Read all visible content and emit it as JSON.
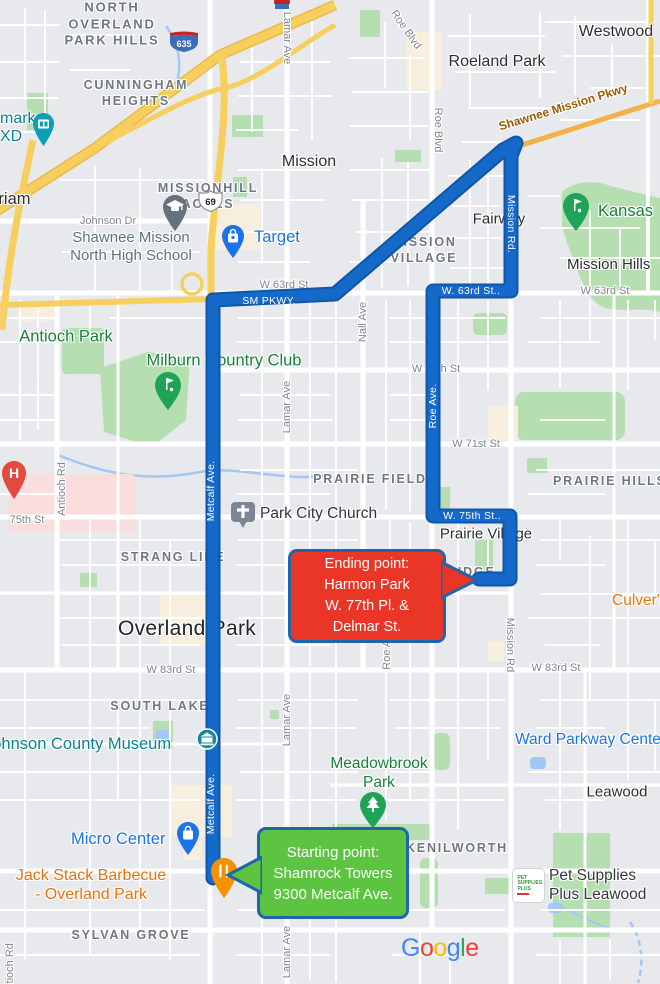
{
  "colors": {
    "route": "#1569c9",
    "route_casing": "#0e57a8",
    "park_green": "#b5dfb0",
    "water_blue": "#a2c6f5",
    "highway_yellow": "#f6cf5e",
    "poi_blue": "#1a73e8",
    "poi_green": "#188038",
    "poi_teal": "#0c818f",
    "poi_orange": "#e8710a",
    "hospital_red": "#e04a3f",
    "restaurant_pin_orange": "#f39200",
    "callout_border_blue": "#1f64ad",
    "callout_red": "#ea3626",
    "callout_green": "#5cc441"
  },
  "route": {
    "labels": {
      "sm_pkwy": "SM PKWY.",
      "w63rd": "W. 63rd St..",
      "mission_rd": "Mission Rd.",
      "roe_ave": "Roe Ave.",
      "metcalf_ave": "Metcalf Ave.",
      "w75th": "W. 75th St.."
    }
  },
  "callouts": {
    "end": {
      "text": "Ending point:\nHarmon Park\nW. 77th Pl. &\nDelmar St.",
      "fill": "#ea3626",
      "border": "#1f64ad"
    },
    "start": {
      "text": "Starting point:\nShamrock Towers\n9300 Metcalf Ave.",
      "fill": "#5cc441",
      "border": "#1f64ad"
    }
  },
  "cities": {
    "merriam": "Merriam",
    "mission": "Mission",
    "roeland_park": "Roeland Park",
    "westwood": "Westwood",
    "fairway": "Fairway",
    "mission_hills": "Mission Hills",
    "prairie_village": "Prairie Village",
    "overland_park": "Overland Park",
    "leawood": "Leawood"
  },
  "neighborhoods": {
    "north_overland_park_hills": "NORTH\nOVERLAND\nPARK HILLS",
    "cunningham_heights": "CUNNINGHAM\nHEIGHTS",
    "missionhill_acres": "MISSIONHILL\nACRES",
    "mission_village": "MISSION\nVILLAGE",
    "prairie_field": "PRAIRIE FIELD",
    "prairie_hills": "PRAIRIE HILLS",
    "strang_line": "STRANG LINE",
    "ridge": "RIDGE",
    "south_lakes": "SOUTH LAKES",
    "kenilworth": "KENILWORTH",
    "sylvan_grove": "SYLVAN GROVE"
  },
  "streets": {
    "johnson_dr": "Johnson Dr",
    "lamar_ave": "Lamar Ave",
    "roe_blvd": "Roe Blvd",
    "nall_ave": "Nall Ave",
    "antioch_rd": "Antioch Rd",
    "mission_rd": "Mission Rd",
    "roe_ave": "Roe Ave",
    "w_63rd_st": "W 63rd St",
    "w_67th_st": "W 67th St",
    "w_71st_st": "W 71st St",
    "w_75th_st_short": "75th St",
    "w_83rd_st": "W 83rd St",
    "shawnee_mission_pkwy": "Shawnee Mission Pkwy"
  },
  "pois": {
    "theater": "mark\nXD",
    "school": "Shawnee Mission\nNorth High School",
    "target": "Target",
    "antioch_park": "Antioch Park",
    "milburn_country_club": "Milburn Country Club",
    "kansas": "Kansas",
    "park_city_church": "Park City Church",
    "museum": "Johnson County Museum",
    "ward_parkway_center": "Ward Parkway Center",
    "meadowbrook_park": "Meadowbrook\nPark",
    "micro_center": "Micro Center",
    "jack_stack": "Jack Stack Barbecue\n- Overland Park",
    "culvers": "Culver's",
    "pet_supplies": "Pet Supplies\nPlus Leawood",
    "pet_logo": "PET\nSUPPLIES\nPLUS"
  },
  "shields": {
    "i635": "635",
    "us69": "69"
  },
  "icons": {
    "hospital_h": "H"
  },
  "google_logo": {
    "g1": "G",
    "o1": "o",
    "o2": "o",
    "g2": "g",
    "l": "l",
    "e": "e"
  }
}
